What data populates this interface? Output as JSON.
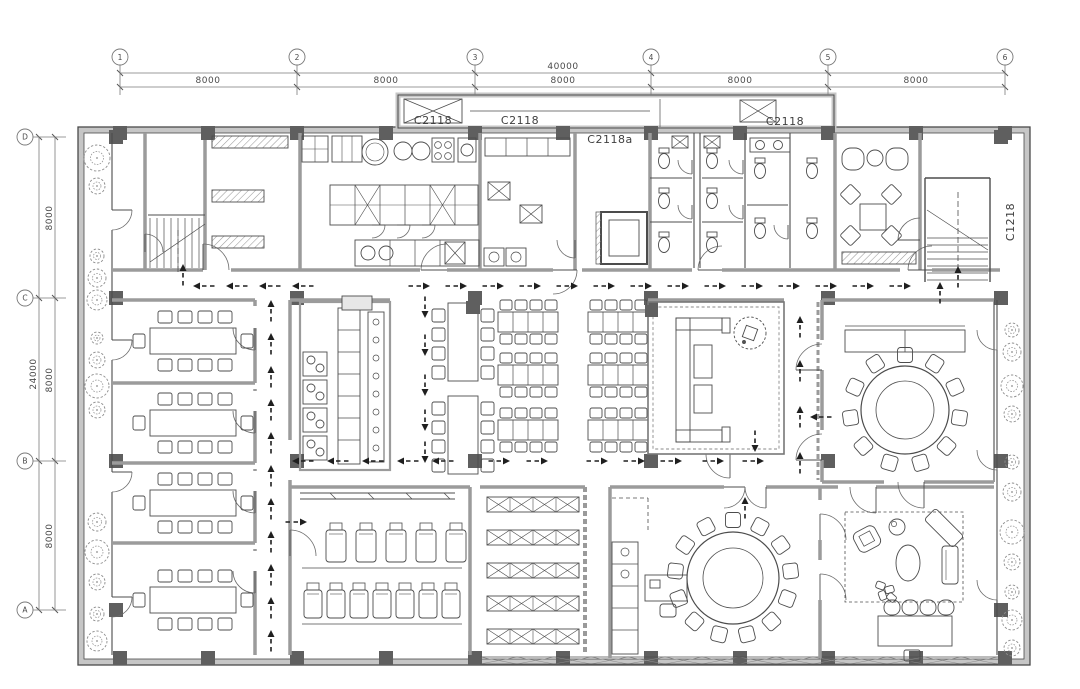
{
  "drawing": {
    "type": "architectural-floor-plan",
    "window_labels": [
      "C2118",
      "C2118",
      "C2118a",
      "C2118",
      "C1218"
    ],
    "dimensions": {
      "top_total": "40000",
      "top_segments": [
        "8000",
        "8000",
        "8000",
        "8000",
        "8000"
      ],
      "left_total": "24000",
      "left_segments": [
        "8000",
        "8000",
        "8000"
      ]
    },
    "grid_axes": {
      "top": [
        "1",
        "2",
        "3",
        "4",
        "5",
        "6"
      ],
      "left": [
        "D",
        "C",
        "B",
        "A"
      ]
    },
    "colors": {
      "paper": "#ffffff",
      "line": "#4c4c4c",
      "wall": "#9b9b9b",
      "wall_dark": "#6e6e6e",
      "column": "#5f5f5f",
      "hatch": "#9a9a9a",
      "arrow": "#1f1f1f",
      "dim": "#5a5a5a",
      "tree": "#8d8d8d"
    }
  }
}
